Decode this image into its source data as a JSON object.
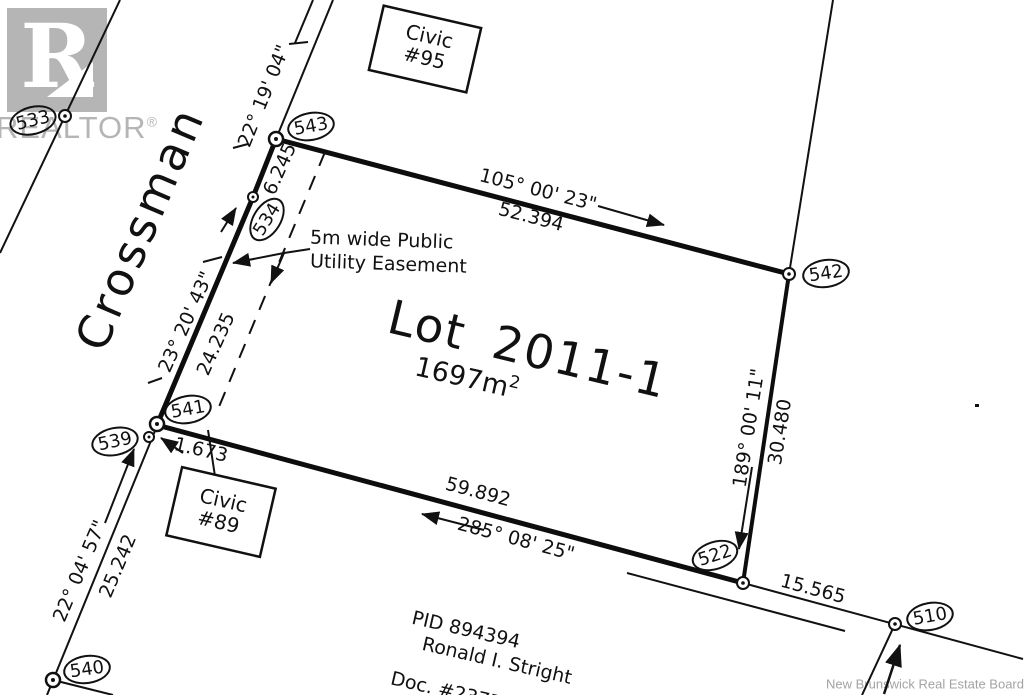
{
  "branding": {
    "logo_letter": "R",
    "logo_word": "REALTOR",
    "registered": "®",
    "watermark": "New Brunswick Real Estate Board"
  },
  "street": {
    "name": "Crossman"
  },
  "lot": {
    "title": "Lot 2011-1",
    "area": "1697m",
    "area_sup": "2"
  },
  "easement": {
    "line1": "5m wide Public",
    "line2": "Utility Easement"
  },
  "buildings": {
    "civic_95": {
      "line1": "Civic",
      "line2": "#95"
    },
    "civic_89": {
      "line1": "Civic",
      "line2": "#89"
    }
  },
  "adjacent_owner": {
    "pid": "PID 894394",
    "name": "Ronald I. Stright",
    "doc": "Doc. #2377"
  },
  "dimensions": {
    "road_upper_bearing": "22° 19' 04\"",
    "frontage_upper": "6.245",
    "west_bearing": "23° 20' 43\"",
    "west_distance": "24.235",
    "road_lower_bearing": "22° 04' 57\"",
    "road_lower_distance": "25.242",
    "north_bearing": "105° 00' 23\"",
    "north_distance": "52.394",
    "east_bearing": "189° 00' 11\"",
    "east_distance": "30.480",
    "south_bearing": "285° 08' 25\"",
    "south_distance": "59.892",
    "tie_distance": "1.673",
    "extension_distance": "15.565"
  },
  "survey_points": {
    "p533": "533",
    "p534": "534",
    "p539": "539",
    "p540": "540",
    "p541": "541",
    "p542": "542",
    "p543": "543",
    "p522": "522",
    "p510": "510"
  }
}
